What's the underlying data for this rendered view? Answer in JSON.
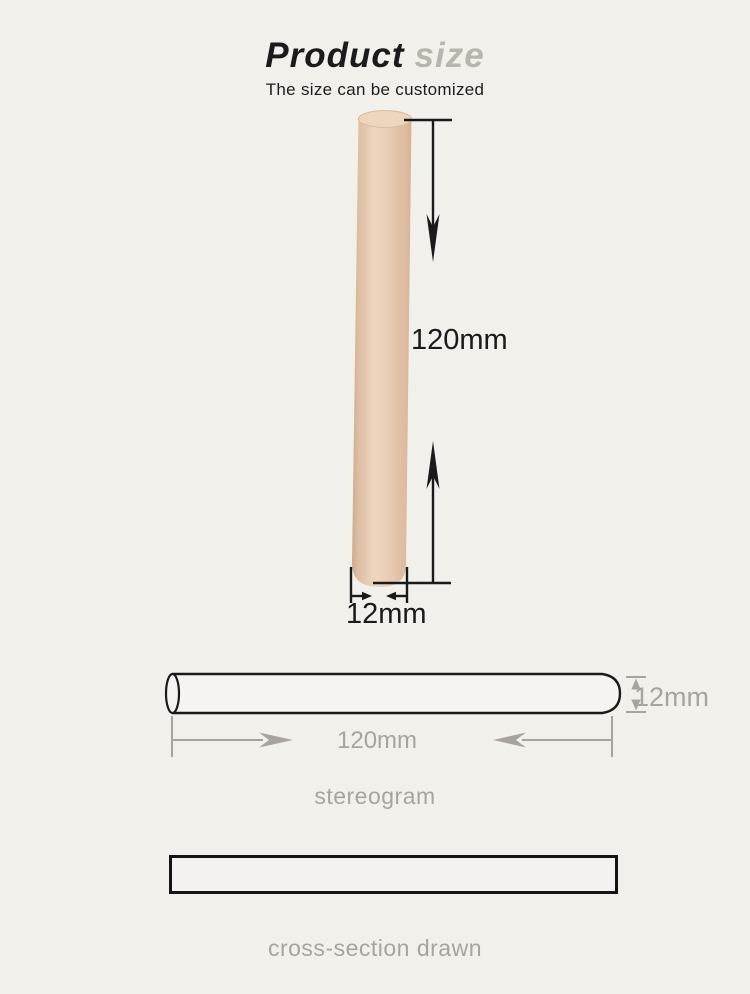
{
  "header": {
    "title_primary": "Product",
    "title_secondary": "size",
    "subtitle": "The size can be customized"
  },
  "front_view": {
    "length_label": "120mm",
    "diameter_label": "12mm"
  },
  "stereogram_view": {
    "length_label": "120mm",
    "diameter_label": "12mm",
    "caption": "stereogram"
  },
  "cross_section": {
    "caption": "cross-section drawn"
  },
  "colors": {
    "background": "#f2f0eb",
    "title_primary": "#1b1b1b",
    "title_accent": "#b9b5ae",
    "line_black": "#1a1a1a",
    "annotation_gray": "#a8a49d",
    "dowel_tan": "#e4c8ae",
    "dowel_highlight": "#eed6bd",
    "dowel_shadow": "#d0ae92"
  }
}
